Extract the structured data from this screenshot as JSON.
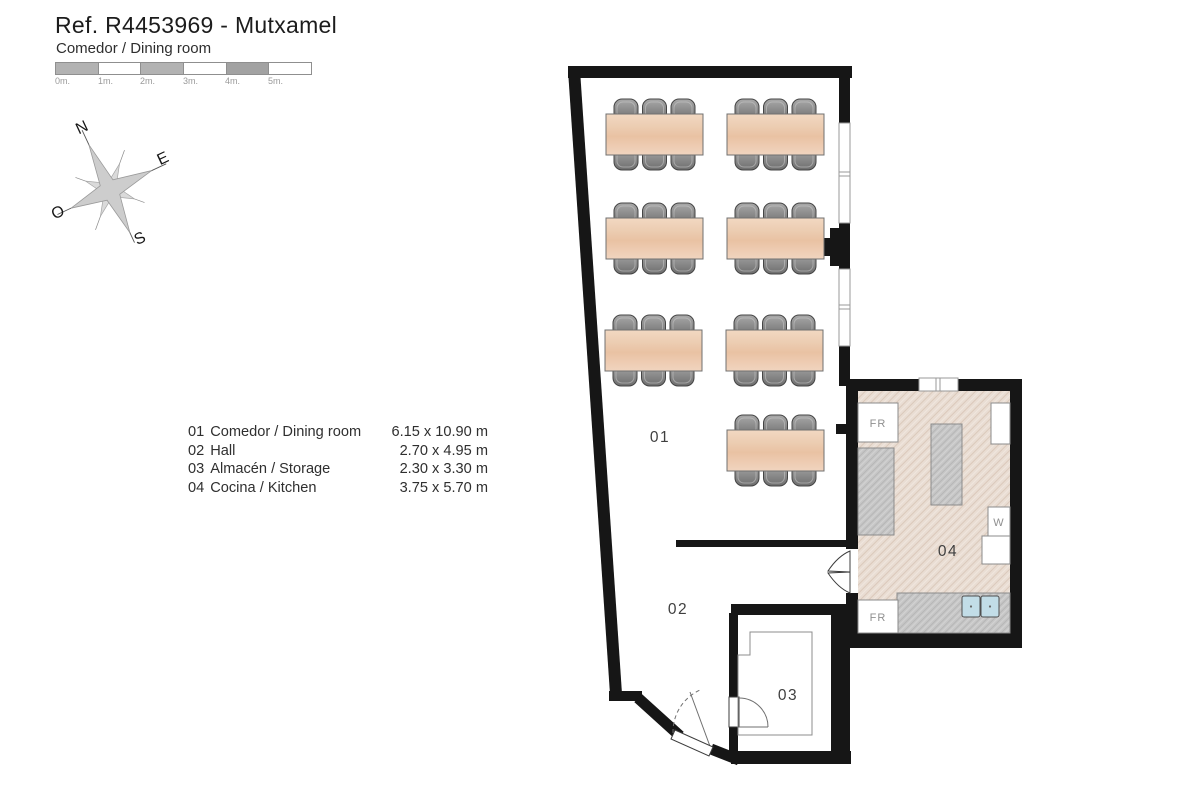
{
  "header": {
    "title": "Ref. R4453969 - Mutxamel",
    "subtitle": "Comedor / Dining room"
  },
  "scale_bar": {
    "labels": [
      "0m.",
      "1m.",
      "2m.",
      "3m.",
      "4m.",
      "5m."
    ]
  },
  "compass": {
    "north": "N",
    "east": "E",
    "south": "S",
    "west": "O"
  },
  "legend": {
    "rooms": [
      {
        "id": "01",
        "name": "Comedor / Dining room",
        "dimensions": "6.15 x 10.90 m"
      },
      {
        "id": "02",
        "name": "Hall",
        "dimensions": "2.70 x 4.95 m"
      },
      {
        "id": "03",
        "name": "Almacén / Storage",
        "dimensions": "2.30 x 3.30 m"
      },
      {
        "id": "04",
        "name": "Cocina / Kitchen",
        "dimensions": "3.75 x 5.70 m"
      }
    ]
  },
  "plan": {
    "room_labels": {
      "dining": "01",
      "hall": "02",
      "storage": "03",
      "kitchen": "04"
    },
    "fixture_labels": {
      "fridge_top": "FR",
      "fridge_bottom": "FR",
      "washer": "W"
    }
  },
  "colors": {
    "wall": "#161616",
    "table_wood": "#ecc7a9",
    "chair_gray": "#8d8d8d",
    "kitchen_floor": "#e9ddd3",
    "counter": "#c6c6c6",
    "sink": "#c2dde7",
    "line": "#9a9a9a",
    "text_dark": "#1d1d1d",
    "text_room": "#3f3f3f",
    "text_muted": "#8f8f8f"
  }
}
